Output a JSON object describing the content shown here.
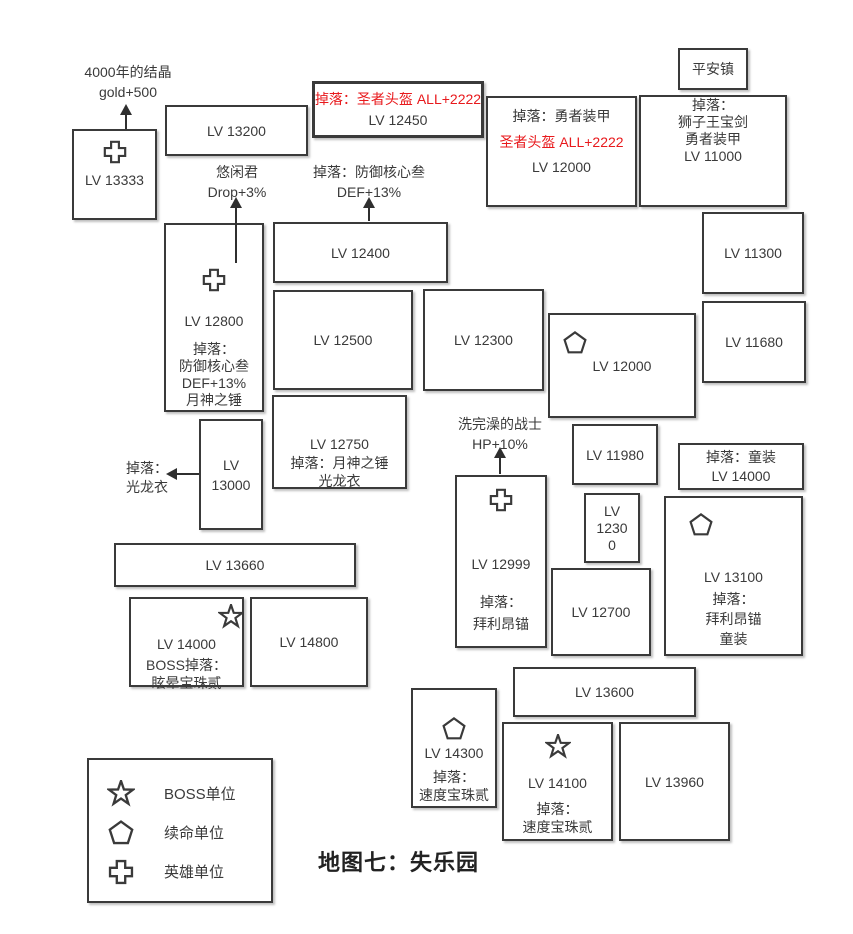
{
  "title": "地图七：失乐园",
  "colors": {
    "ink": "#3a3a3a",
    "red": "#e8191c",
    "bg": "#ffffff",
    "arrow": "#2f2f2f"
  },
  "legend": {
    "x": 87,
    "y": 758,
    "w": 186,
    "h": 145,
    "items": [
      {
        "icon": "star",
        "label": "BOSS单位"
      },
      {
        "icon": "pentagon",
        "label": "续命单位"
      },
      {
        "icon": "cross",
        "label": "英雄单位"
      }
    ]
  },
  "labels": [
    {
      "id": "crystal-bonus",
      "x": 70,
      "y": 62,
      "w": 116,
      "lh": 20,
      "lines": [
        "4000年的结晶",
        "gold+500"
      ]
    },
    {
      "id": "youxianjun-bonus",
      "x": 187,
      "y": 162,
      "w": 100,
      "lh": 20,
      "lines": [
        "悠闲君",
        "Drop+3%"
      ]
    },
    {
      "id": "defense-core-drop",
      "x": 296,
      "y": 162,
      "w": 146,
      "lh": 20,
      "lines": [
        "掉落：防御核心叁",
        "DEF+13%"
      ]
    },
    {
      "id": "bathed-warrior-bonus",
      "x": 438,
      "y": 414,
      "w": 124,
      "lh": 20,
      "lines": [
        "洗完澡的战士",
        "HP+10%"
      ]
    },
    {
      "id": "guanglongyi-drop",
      "x": 126,
      "y": 459,
      "w": 60,
      "lh": 19,
      "align": "left",
      "lines": [
        "掉落：",
        "光龙衣"
      ]
    }
  ],
  "arrows": [
    {
      "dir": "up",
      "x": 126,
      "head": 104,
      "tail": 129
    },
    {
      "dir": "up",
      "x": 236,
      "head": 197,
      "tail": 263
    },
    {
      "dir": "up",
      "x": 369,
      "head": 197,
      "tail": 221
    },
    {
      "dir": "up",
      "x": 500,
      "head": 447,
      "tail": 474
    },
    {
      "dir": "left",
      "y": 474,
      "head": 166,
      "tail": 199
    }
  ],
  "nodes": [
    {
      "id": "lv13333",
      "x": 72,
      "y": 129,
      "w": 85,
      "h": 91,
      "icon": "cross",
      "ipos": "tc",
      "imt": 8,
      "lines": [
        {
          "t": "LV 13333",
          "mt": 6
        }
      ]
    },
    {
      "id": "lv13200",
      "x": 165,
      "y": 105,
      "w": 143,
      "h": 51,
      "vc": true,
      "lines": [
        {
          "t": "LV 13200"
        }
      ]
    },
    {
      "id": "lv12450",
      "x": 312,
      "y": 81,
      "w": 172,
      "h": 57,
      "thick": true,
      "vc": true,
      "lh": 21,
      "lines": [
        {
          "t": "掉落：圣者头盔 ALL+2222",
          "red": true
        },
        {
          "t": "LV 12450"
        }
      ]
    },
    {
      "id": "lv12000-armor",
      "x": 486,
      "y": 96,
      "w": 151,
      "h": 111,
      "tt": 8,
      "lh": 21,
      "lines": [
        {
          "t": "掉落：勇者装甲"
        },
        {
          "t": "圣者头盔 ALL+2222",
          "red": true,
          "mt": 5
        },
        {
          "t": "LV 12000",
          "mt": 4
        }
      ]
    },
    {
      "id": "pinganzhen",
      "x": 678,
      "y": 48,
      "w": 70,
      "h": 42,
      "vc": true,
      "lines": [
        {
          "t": "平安镇"
        }
      ]
    },
    {
      "id": "lv11000",
      "x": 639,
      "y": 95,
      "w": 148,
      "h": 112,
      "tt": 0,
      "lh": 17,
      "lines": [
        {
          "t": "掉落："
        },
        {
          "t": "狮子王宝剑"
        },
        {
          "t": "勇者装甲"
        },
        {
          "t": "LV 11000"
        }
      ]
    },
    {
      "id": "lv12800",
      "x": 164,
      "y": 223,
      "w": 100,
      "h": 189,
      "icon": "cross",
      "ipos": "tc",
      "imt": 42,
      "lh": 17,
      "lines": [
        {
          "t": "LV 12800",
          "mt": 20
        },
        {
          "t": "掉落：",
          "mt": 11
        },
        {
          "t": "防御核心叁"
        },
        {
          "t": "DEF+13%"
        },
        {
          "t": "月神之锤"
        }
      ]
    },
    {
      "id": "lv12400",
      "x": 273,
      "y": 222,
      "w": 175,
      "h": 61,
      "vc": true,
      "lines": [
        {
          "t": "LV 12400"
        }
      ]
    },
    {
      "id": "lv11300",
      "x": 702,
      "y": 212,
      "w": 102,
      "h": 82,
      "vc": true,
      "lines": [
        {
          "t": "LV 11300"
        }
      ]
    },
    {
      "id": "lv12500",
      "x": 273,
      "y": 290,
      "w": 140,
      "h": 100,
      "vc": true,
      "lines": [
        {
          "t": "LV 12500"
        }
      ]
    },
    {
      "id": "lv12300",
      "x": 423,
      "y": 289,
      "w": 121,
      "h": 102,
      "vc": true,
      "lines": [
        {
          "t": "LV 12300"
        }
      ]
    },
    {
      "id": "lv12000-pent",
      "x": 548,
      "y": 313,
      "w": 148,
      "h": 105,
      "icon": "pentagon",
      "ipos": "tl",
      "ix": 12,
      "iy": 15,
      "vc": true,
      "lines": [
        {
          "t": "LV 12000"
        }
      ]
    },
    {
      "id": "lv11680",
      "x": 702,
      "y": 301,
      "w": 104,
      "h": 82,
      "vc": true,
      "lines": [
        {
          "t": "LV 11680"
        }
      ]
    },
    {
      "id": "lv13000",
      "x": 199,
      "y": 419,
      "w": 64,
      "h": 111,
      "vc": true,
      "lh": 20,
      "lines": [
        {
          "t": "LV"
        },
        {
          "t": "13000"
        }
      ]
    },
    {
      "id": "lv12750",
      "x": 272,
      "y": 395,
      "w": 135,
      "h": 94,
      "tt": 38,
      "lh": 18,
      "lines": [
        {
          "t": "LV 12750"
        },
        {
          "t": "掉落：月神之锤",
          "mt": 1
        },
        {
          "t": "光龙衣"
        }
      ]
    },
    {
      "id": "lv11980",
      "x": 572,
      "y": 424,
      "w": 86,
      "h": 61,
      "vc": true,
      "lines": [
        {
          "t": "LV 11980"
        }
      ]
    },
    {
      "id": "lv12999",
      "x": 455,
      "y": 475,
      "w": 92,
      "h": 173,
      "icon": "cross",
      "ipos": "tc",
      "imt": 10,
      "lh": 18,
      "lines": [
        {
          "t": "LV 12999",
          "mt": 42
        },
        {
          "t": "掉落：",
          "mt": 20
        },
        {
          "t": "拜利昂锚",
          "mt": 4
        }
      ]
    },
    {
      "id": "lv12300-small",
      "x": 584,
      "y": 493,
      "w": 56,
      "h": 70,
      "vc": true,
      "lh": 17,
      "lines": [
        {
          "t": "LV"
        },
        {
          "t": "1230"
        },
        {
          "t": "0"
        }
      ]
    },
    {
      "id": "tongzhuang-drop",
      "x": 678,
      "y": 443,
      "w": 126,
      "h": 47,
      "vc": true,
      "lh": 19,
      "lines": [
        {
          "t": "掉落：童装"
        },
        {
          "t": "LV 14000"
        }
      ]
    },
    {
      "id": "lv13100",
      "x": 664,
      "y": 496,
      "w": 139,
      "h": 160,
      "icon": "pentagon",
      "ipos": "tl",
      "ix": 22,
      "iy": 14,
      "tt": 70,
      "lh": 18,
      "lines": [
        {
          "t": "LV 13100"
        },
        {
          "t": "掉落：",
          "mt": 4
        },
        {
          "t": "拜利昂锚",
          "mt": 2
        },
        {
          "t": "童装",
          "mt": 2
        }
      ]
    },
    {
      "id": "lv12700",
      "x": 551,
      "y": 568,
      "w": 100,
      "h": 88,
      "vc": true,
      "lines": [
        {
          "t": "LV 12700"
        }
      ]
    },
    {
      "id": "lv13660",
      "x": 114,
      "y": 543,
      "w": 242,
      "h": 44,
      "vc": true,
      "lines": [
        {
          "t": "LV 13660"
        }
      ]
    },
    {
      "id": "lv14000-boss",
      "x": 129,
      "y": 597,
      "w": 115,
      "h": 90,
      "icon": "star",
      "ipos": "tr",
      "ix": -2,
      "iy": 5,
      "tt": 36,
      "lh": 18,
      "lines": [
        {
          "t": "LV 14000"
        },
        {
          "t": "BOSS掉落：",
          "mt": 3
        },
        {
          "t": "眩晕宝珠贰"
        }
      ]
    },
    {
      "id": "lv14800",
      "x": 250,
      "y": 597,
      "w": 118,
      "h": 90,
      "vc": true,
      "lines": [
        {
          "t": "LV 14800"
        }
      ]
    },
    {
      "id": "lv13600",
      "x": 513,
      "y": 667,
      "w": 183,
      "h": 50,
      "vc": true,
      "lines": [
        {
          "t": "LV 13600"
        }
      ]
    },
    {
      "id": "lv14300",
      "x": 411,
      "y": 688,
      "w": 86,
      "h": 120,
      "icon": "pentagon",
      "ipos": "tc",
      "imt": 26,
      "lh": 18,
      "lines": [
        {
          "t": "LV 14300",
          "mt": 2
        },
        {
          "t": "掉落：",
          "mt": 6
        },
        {
          "t": "速度宝珠贰"
        }
      ]
    },
    {
      "id": "lv14100",
      "x": 502,
      "y": 722,
      "w": 111,
      "h": 119,
      "icon": "star",
      "ipos": "tc",
      "imt": 10,
      "lh": 18,
      "lines": [
        {
          "t": "LV 14100",
          "mt": 14
        },
        {
          "t": "掉落：",
          "mt": 8
        },
        {
          "t": "速度宝珠贰"
        }
      ]
    },
    {
      "id": "lv13960",
      "x": 619,
      "y": 722,
      "w": 111,
      "h": 119,
      "vc": true,
      "lines": [
        {
          "t": "LV 13960"
        }
      ]
    }
  ]
}
